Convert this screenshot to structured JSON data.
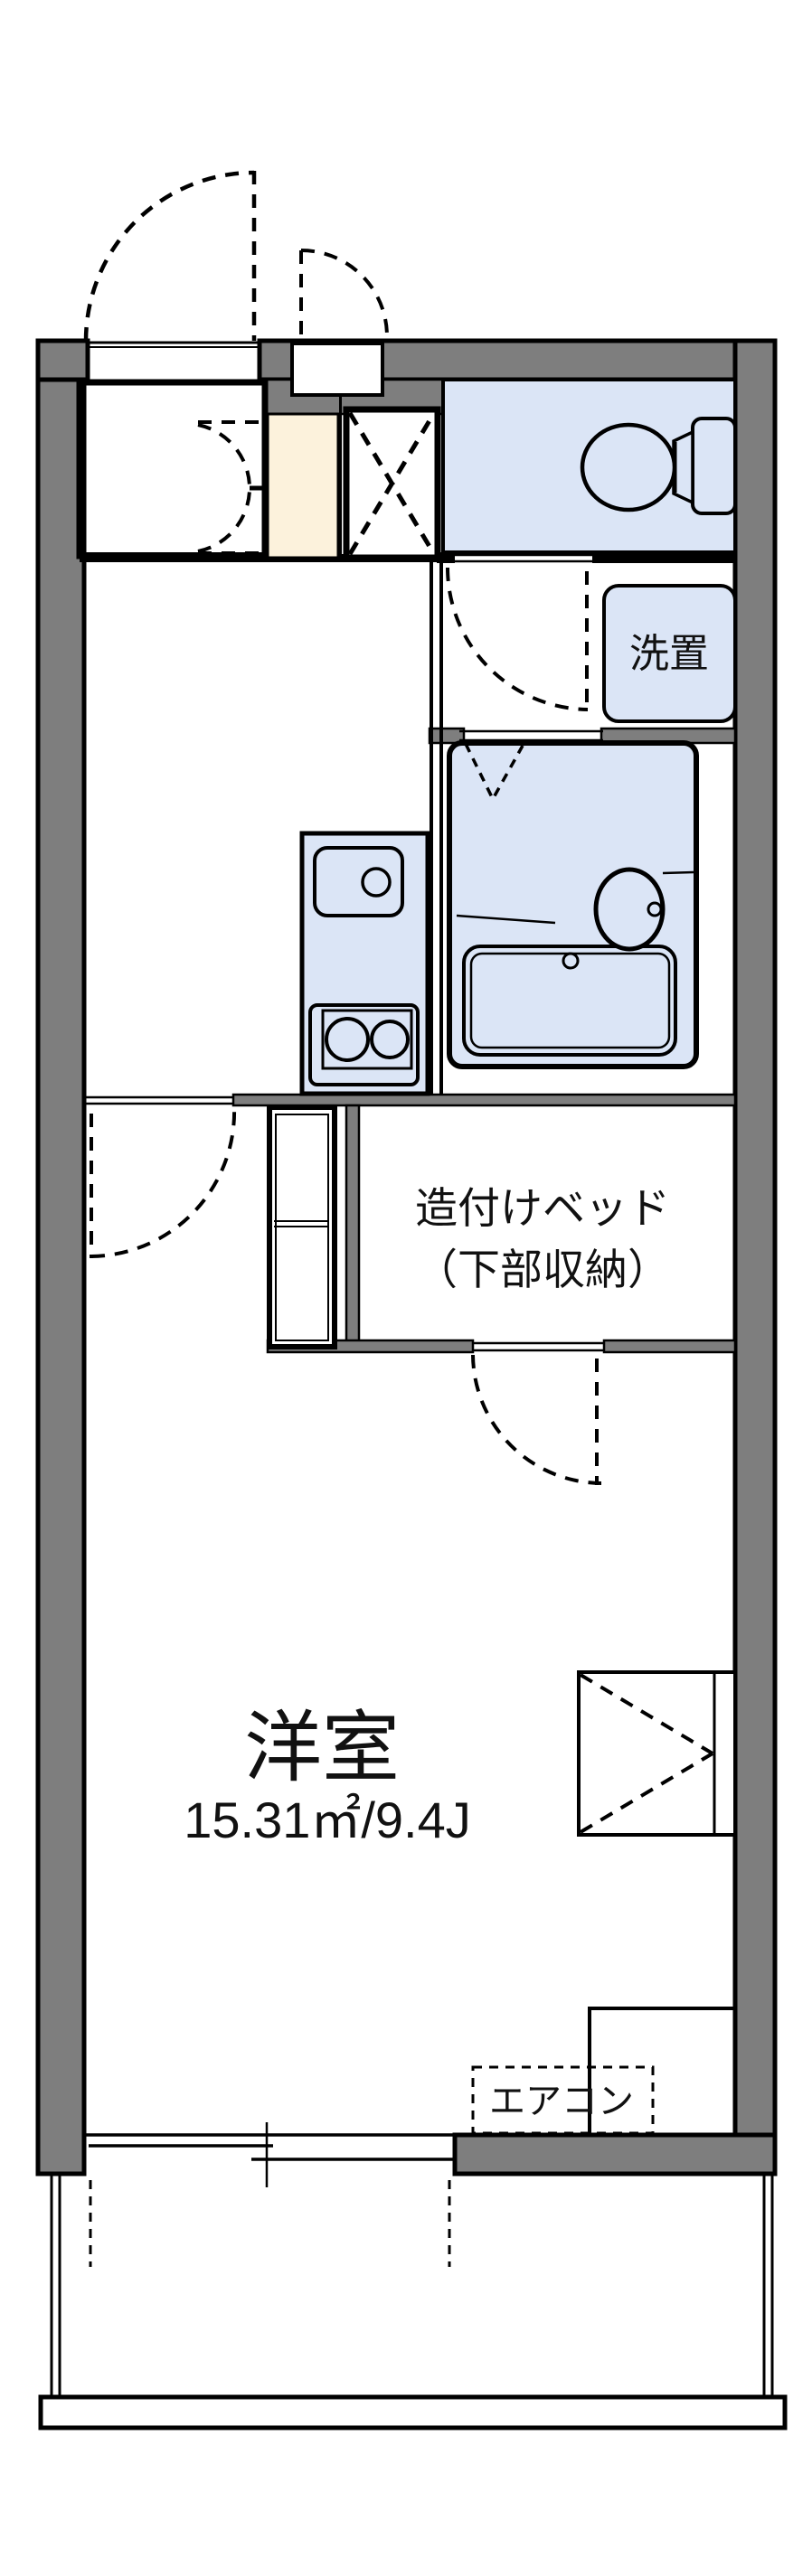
{
  "plan": {
    "type": "japanese-apartment-floor-plan",
    "labels": {
      "washer_space": "洗置",
      "bed_line1": "造付けベッド",
      "bed_line2": "（下部収納）",
      "main_room_name": "洋室",
      "main_room_area": "15.31㎡/9.4J",
      "aircon": "エアコン"
    },
    "colors": {
      "wall": "#7e7e7e",
      "wet_room_fill": "#dbe5f6",
      "genkan_fill": "#fcf2dc",
      "line": "#000000",
      "paper": "#ffffff"
    },
    "rooms": [
      {
        "name": "entrance-hall",
        "label": ""
      },
      {
        "name": "toilet-room",
        "label": ""
      },
      {
        "name": "washer-space",
        "label": "洗置"
      },
      {
        "name": "bathroom-unit",
        "label": ""
      },
      {
        "name": "kitchen-area",
        "label": ""
      },
      {
        "name": "built-in-bed",
        "label": "造付けベッド（下部収納）"
      },
      {
        "name": "western-room",
        "label": "洋室",
        "area": "15.31㎡/9.4J"
      },
      {
        "name": "balcony",
        "label": ""
      }
    ],
    "fixtures": [
      "entrance-door",
      "meter-box-door",
      "shoe-box",
      "genkan-floor",
      "double-swing-door",
      "toilet",
      "washing-machine-space",
      "bathtub",
      "wash-basin",
      "kitchen-sink",
      "gas-stove",
      "closet",
      "air-conditioner",
      "sliding-window",
      "balcony-railing"
    ]
  }
}
